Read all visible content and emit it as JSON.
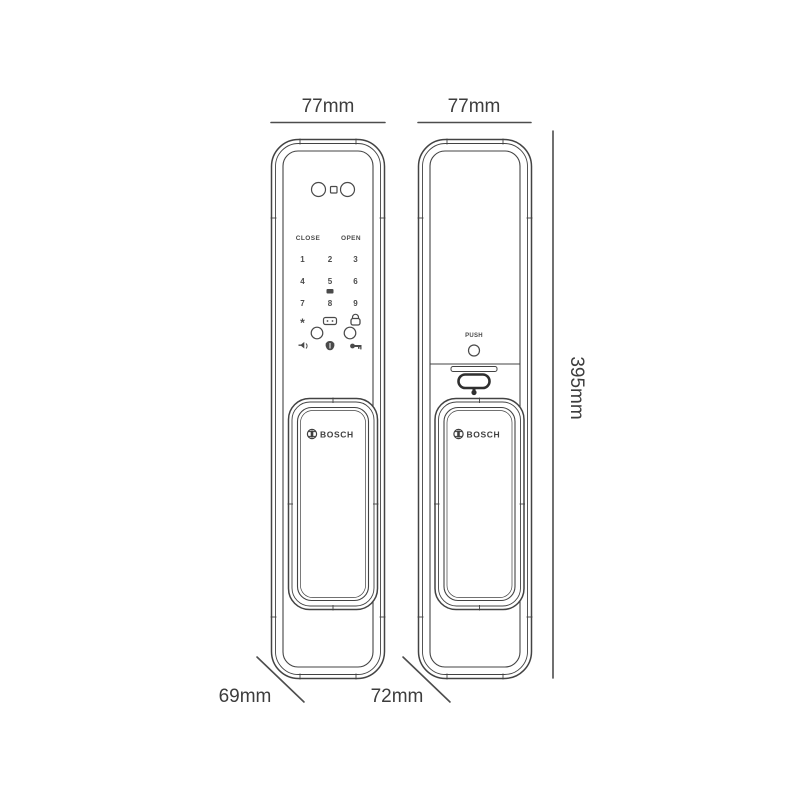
{
  "page": {
    "background": "#ffffff",
    "line_color": "#434343",
    "text_color": "#3d3d3d"
  },
  "dimensions": {
    "front_width": "77mm",
    "back_width": "77mm",
    "height": "395mm",
    "front_depth": "69mm",
    "back_depth": "72mm"
  },
  "front_view": {
    "brand": "BOSCH",
    "keypad": {
      "close_label": "CLOSE",
      "open_label": "OPEN",
      "rows": [
        [
          "1",
          "2",
          "3"
        ],
        [
          "4",
          "5",
          "6"
        ],
        [
          "7",
          "8",
          "9"
        ]
      ],
      "star_key": "*",
      "zero_key": "0"
    }
  },
  "back_view": {
    "brand": "BOSCH",
    "push_label": "PUSH"
  }
}
